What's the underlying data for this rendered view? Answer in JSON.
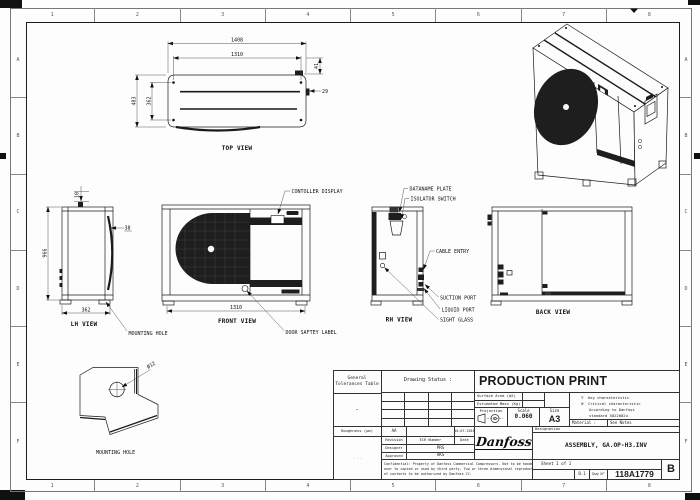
{
  "sheet": {
    "cols": [
      "1",
      "2",
      "3",
      "4",
      "5",
      "6",
      "7",
      "8"
    ],
    "rows": [
      "A",
      "B",
      "C",
      "D",
      "E",
      "F"
    ]
  },
  "views": {
    "top": {
      "label": "TOP VIEW",
      "dim_width_outer": "1408",
      "dim_width_inner": "1310",
      "dim_depth_outer": "483",
      "dim_depth_inner": "362",
      "dim_offset_a": "41",
      "dim_offset_b": "29"
    },
    "lh": {
      "label": "LH VIEW",
      "dim_top": "10",
      "dim_height": "966",
      "dim_offset": "38",
      "dim_depth": "362",
      "callout_mounting_hole": "MOUNTING HOLE"
    },
    "front": {
      "label": "FRONT VIEW",
      "dim_width": "1310",
      "callout_controller": "CONTOLLER DISPLAY",
      "callout_door_label": "DOOR SAFTEY LABEL"
    },
    "rh": {
      "label": "RH VIEW",
      "callout_dataname": "DATANAME PLATE",
      "callout_isolator": "ISOLATOR SWITCH",
      "callout_cable": "CABLE ENTRY",
      "callout_suction": "SUCTION PORT",
      "callout_liquid": "LIQUID PORT",
      "callout_sight": "SIGHT GLASS"
    },
    "back": {
      "label": "BACK VIEW"
    },
    "detail": {
      "label": "MOUNTING HOLE",
      "hole_dim": "Ø12"
    }
  },
  "title_block": {
    "tolerances_title": "General Tolerances Table",
    "tolerances_value": "-",
    "roughness_label": "Roughness (µm)",
    "notes_marks": ". ..",
    "drawing_status_label": "Drawing Status :",
    "drawing_status": "PRODUCTION PRINT",
    "surface_area_label": "Surface Area (m2)",
    "estimated_mass_label": "Estimated Mass (Kg)",
    "projection_label": "Projection",
    "scale_label": "Scale",
    "scale_value": "0.060",
    "size_label": "Size",
    "size_value": "A3",
    "key_symbol": "▽",
    "key_characteristic": "Key characteristic",
    "critical_symbol": "⊗",
    "critical_characteristic": "Critical characteristic",
    "standard_note_1": "According to Danfoss",
    "standard_note_2": "standard 50220024",
    "material_label": "Material :",
    "material_value": "See Notes",
    "designation_label": "Designation",
    "designation_value": "ASSEMBLY, GA.OP-H3.INV",
    "revision_current": "AA",
    "revision_date": "16-07-2018",
    "rev_col_revision": "Revision",
    "rev_col_ecr": "ECR Number",
    "rev_col_date": "Date",
    "designer_label": "Designer",
    "designer_value": "PRS",
    "approved_label": "Approved",
    "approved_value": "AKS",
    "logo": "Danfoss",
    "confidential_lines": [
      "Confidential: Property of Danfoss Commercial Compressors. Not to be handed",
      "over to copied or used by third party. Two or three dimensional reproduction",
      "of contents to be authorized by Danfoss CC."
    ],
    "sheet_info": "Sheet 1 of 1",
    "format_note": "B.1",
    "dwg_no_label": "Dwg N°",
    "dwg_no": "118A1779",
    "revision_letter": "B"
  }
}
